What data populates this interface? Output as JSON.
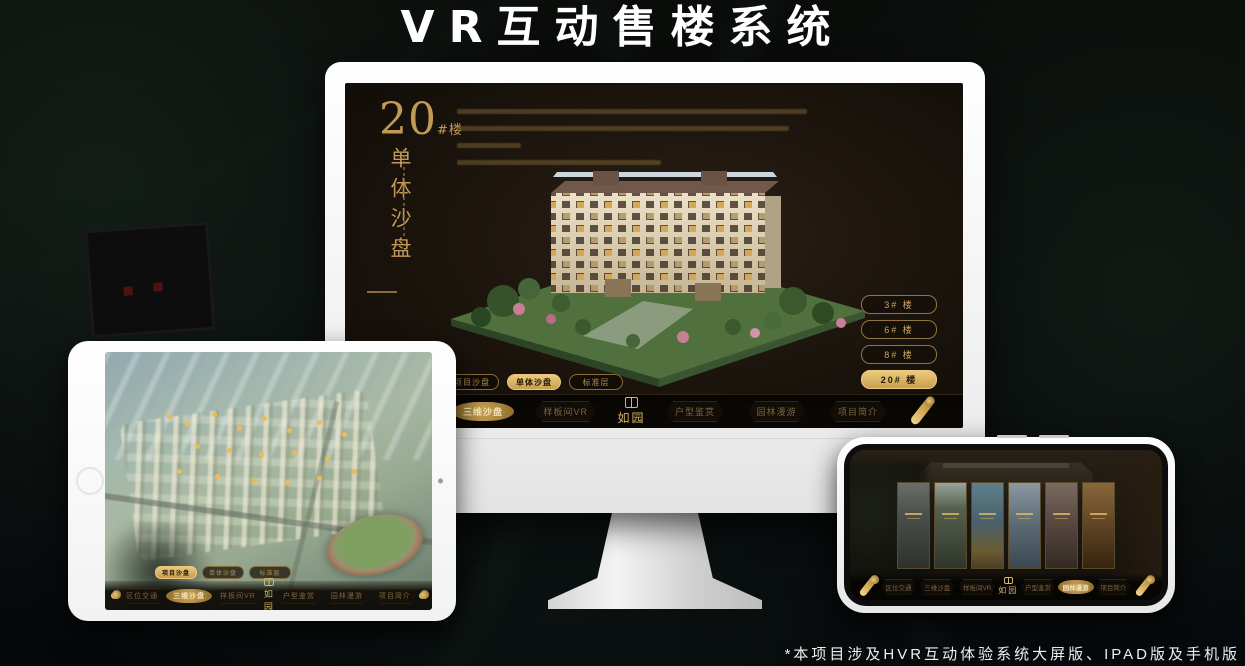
{
  "page": {
    "title": "VR互动售楼系统",
    "footnote": "*本项目涉及HVR互动体验系统大屏版、IPAD版及手机版"
  },
  "brand": {
    "logo_text": "如园",
    "gold": "#c9a45c",
    "gold_bright": "#ecc87e",
    "screen_bg": "#1b140d"
  },
  "monitor": {
    "headline": {
      "number": "20",
      "suffix": "#楼",
      "vertical_label": "单体沙盘"
    },
    "floor_buttons": [
      {
        "label": "3# 楼",
        "active": false
      },
      {
        "label": "6# 楼",
        "active": false
      },
      {
        "label": "8# 楼",
        "active": false
      },
      {
        "label": "20# 楼",
        "active": true
      }
    ],
    "sub_tabs": [
      {
        "label": "项目沙盘",
        "active": false
      },
      {
        "label": "单体沙盘",
        "active": true
      },
      {
        "label": "标准层",
        "active": false
      }
    ],
    "nav": [
      {
        "label": "区位交通",
        "active": false
      },
      {
        "label": "三维沙盘",
        "active": true
      },
      {
        "label": "样板间VR",
        "active": false
      },
      {
        "label": "户型鉴赏",
        "active": false
      },
      {
        "label": "园林漫游",
        "active": false
      },
      {
        "label": "项目简介",
        "active": false
      }
    ]
  },
  "tablet": {
    "sub_tabs": [
      {
        "label": "项目沙盘",
        "active": true
      },
      {
        "label": "单体沙盘",
        "active": false
      },
      {
        "label": "标准层",
        "active": false
      }
    ],
    "nav": [
      {
        "label": "区位交通",
        "active": false
      },
      {
        "label": "三维沙盘",
        "active": true
      },
      {
        "label": "样板间VR",
        "active": false
      },
      {
        "label": "户型鉴赏",
        "active": false
      },
      {
        "label": "园林漫游",
        "active": false
      },
      {
        "label": "项目简介",
        "active": false
      }
    ]
  },
  "phone": {
    "nav": [
      {
        "label": "区位交通",
        "active": false
      },
      {
        "label": "三维沙盘",
        "active": false
      },
      {
        "label": "样板间VR",
        "active": false
      },
      {
        "label": "户型鉴赏",
        "active": false
      },
      {
        "label": "园林漫游",
        "active": true
      },
      {
        "label": "项目简介",
        "active": false
      }
    ]
  }
}
